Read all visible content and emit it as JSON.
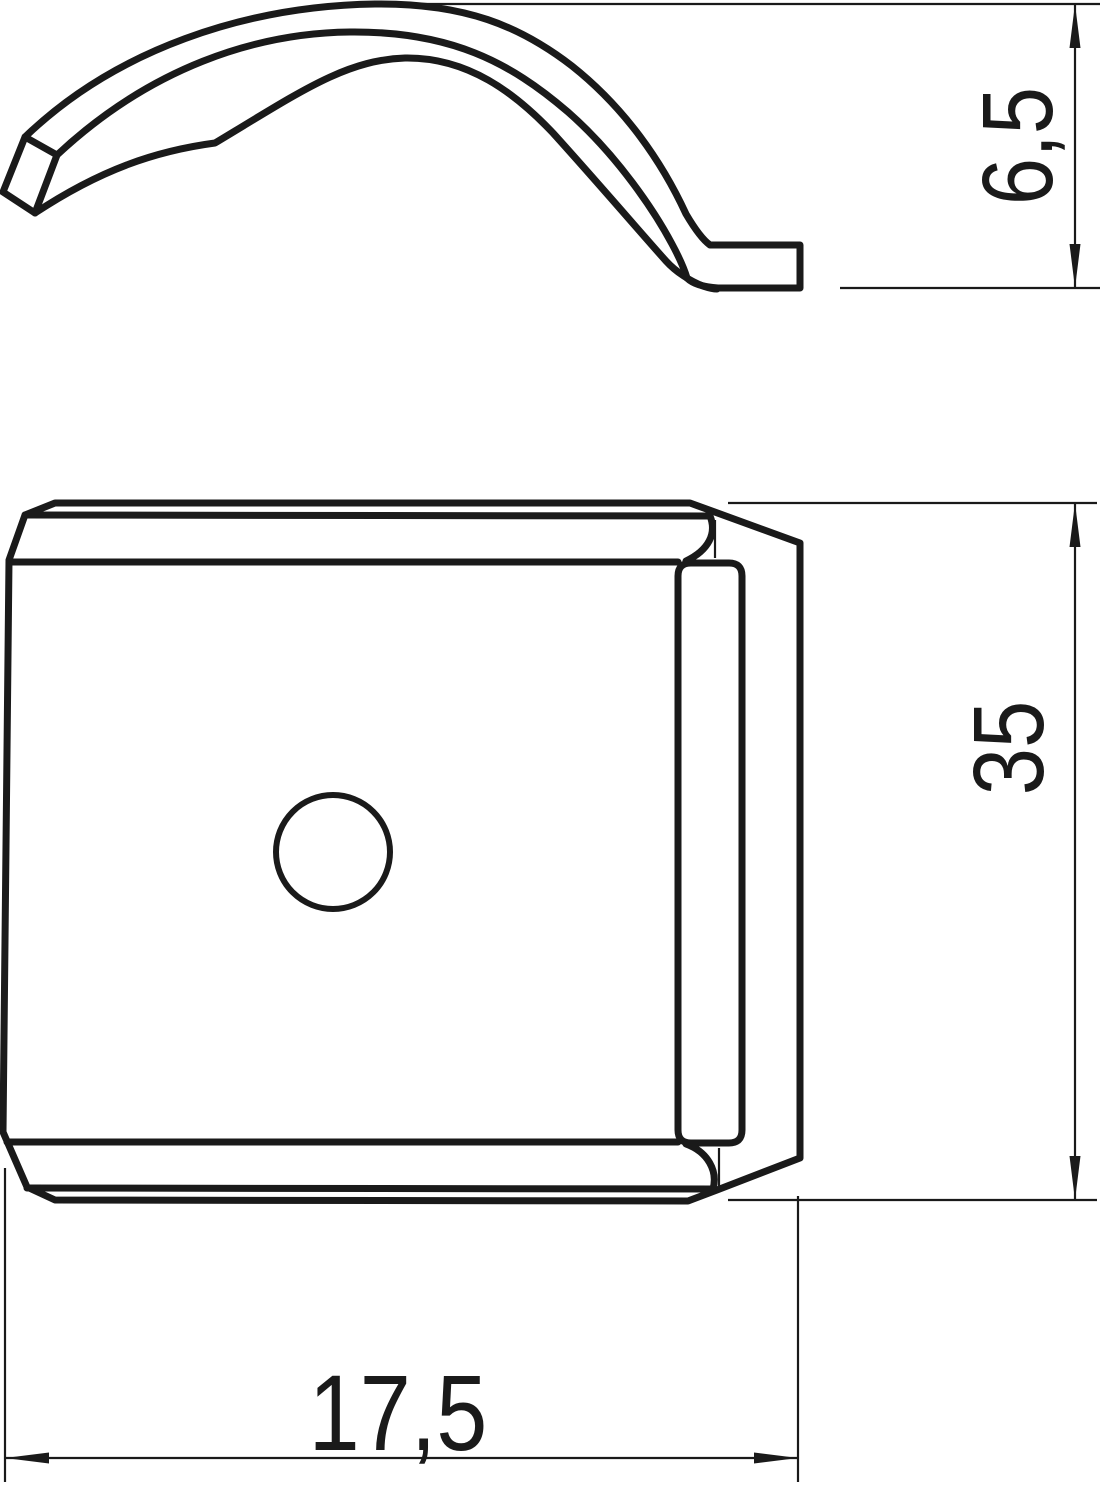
{
  "colors": {
    "background": "#ffffff",
    "ink": "#1a1a1a"
  },
  "drawing": {
    "type": "technical-drawing",
    "views": [
      {
        "id": "side-profile-view",
        "description": "curved spring clip profile, side view"
      },
      {
        "id": "front-plate-view",
        "description": "square plate with center hole, front view"
      }
    ],
    "dimensions": {
      "clip_height": {
        "value": "6,5",
        "orientation": "vertical"
      },
      "plate_height": {
        "value": "35",
        "orientation": "vertical"
      },
      "plate_width": {
        "value": "17,5",
        "orientation": "horizontal"
      }
    }
  }
}
